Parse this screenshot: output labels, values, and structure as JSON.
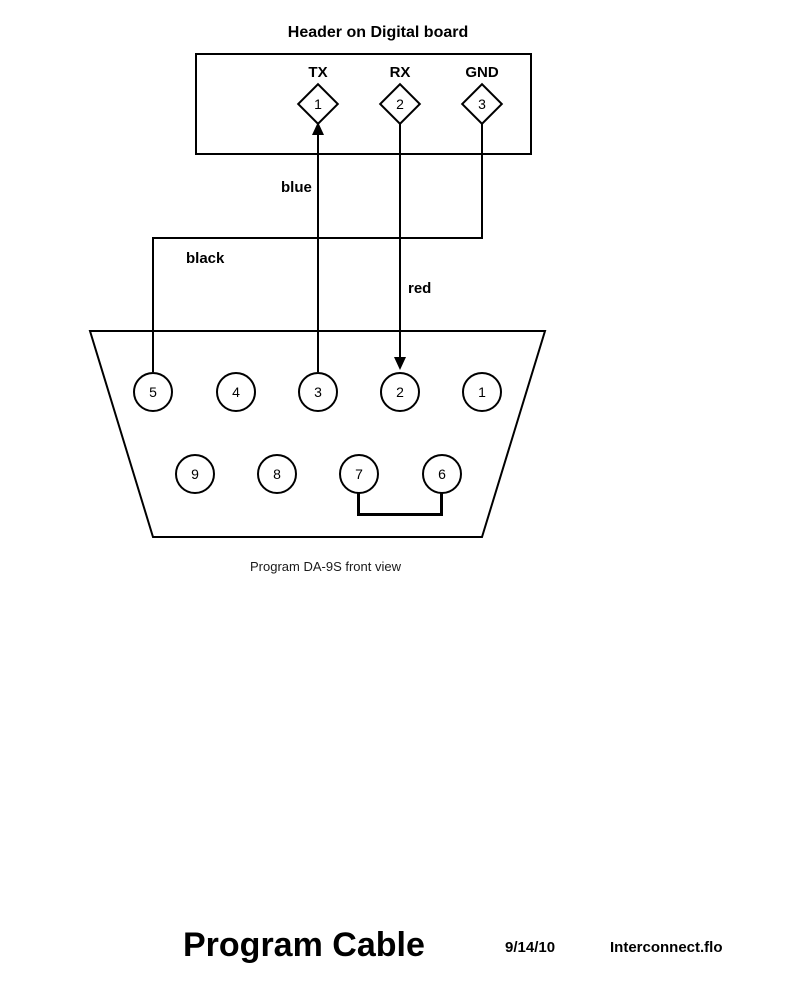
{
  "page": {
    "background": "#ffffff",
    "ink": "#000000"
  },
  "header": {
    "title": "Header on Digital board",
    "pins": [
      {
        "signal": "TX",
        "number": "1"
      },
      {
        "signal": "RX",
        "number": "2"
      },
      {
        "signal": "GND",
        "number": "3"
      }
    ]
  },
  "wires": {
    "blue": {
      "label": "blue",
      "connects": "DA-9S pin 3 to header pin 1 (TX), arrow points up into pin 1"
    },
    "black": {
      "label": "black",
      "connects": "header pin 3 (GND) to DA-9S pin 5"
    },
    "red": {
      "label": "red",
      "connects": "header pin 2 (RX) to DA-9S pin 2, arrow points down into pin 2"
    },
    "jumper": {
      "connects": "DA-9S pin 7 to DA-9S pin 6"
    }
  },
  "connector": {
    "caption": "Program DA-9S front view",
    "row1": [
      "5",
      "4",
      "3",
      "2",
      "1"
    ],
    "row2": [
      "9",
      "8",
      "7",
      "6"
    ]
  },
  "footer": {
    "title": "Program Cable",
    "date": "9/14/10",
    "filename": "Interconnect.flo"
  }
}
